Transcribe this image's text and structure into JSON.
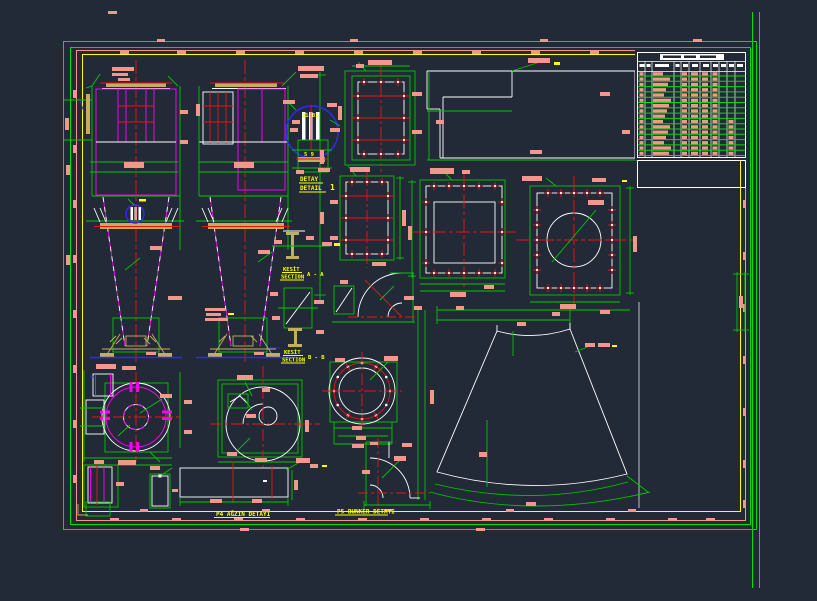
{
  "canvas": {
    "width": 817,
    "height": 601,
    "background": "#232a37"
  },
  "palette": {
    "frame_green": "#00df00",
    "dim_green": "#00c800",
    "entity_magenta": "#ff00ff",
    "centerline_red": "#f01010",
    "dim_text_salmon": "#f2978b",
    "label_yellow": "#ffff00",
    "steel_khaki": "#c4ae5e",
    "detail_blue": "#2b2bff",
    "entity_white": "#ffffff"
  },
  "annotations": {
    "detail_callout": {
      "title_top": "DETAY",
      "title_bottom": "DETAIL",
      "ref_number": "1",
      "dim_top": "21 81",
      "dim_mid": "5 9"
    },
    "section_a": {
      "title_top": "KESİT",
      "title_bottom": "SECTION",
      "ref": "A - A"
    },
    "section_b": {
      "title_top": "KESİT",
      "title_bottom": "SECTION",
      "ref": "B - B"
    },
    "label_p4": "P4 AĞZIN DETAYI",
    "label_p5": "P5 BUNKER DETAYI"
  },
  "bom_table": {
    "row_count": 16,
    "column_count": 10,
    "legibility": "illegible-small-text"
  }
}
